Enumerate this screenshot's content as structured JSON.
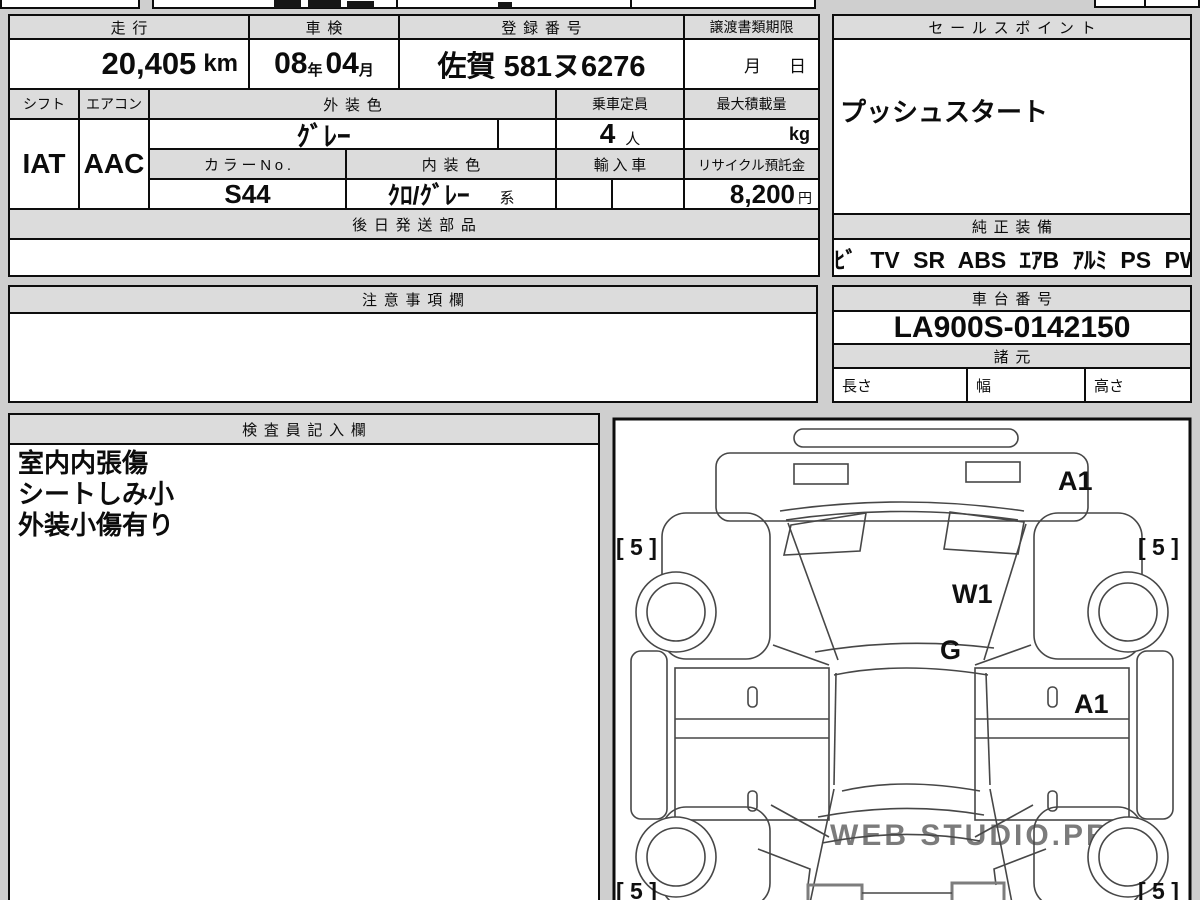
{
  "colors": {
    "page_bg": "#cfcfcf",
    "header_fill": "#dcdcdc",
    "cell_bg": "#ffffff",
    "border": "#0d0d0d",
    "diagram_line": "#474747",
    "watermark": "#c3c3c3"
  },
  "main_table": {
    "mileage_header": "走行",
    "inspection_header": "車検",
    "registration_header": "登録番号",
    "transfer_docs_header": "譲渡書類期限",
    "mileage_value": "20,405",
    "mileage_unit": "km",
    "inspection_year": "08",
    "inspection_year_unit": "年",
    "inspection_month": "04",
    "inspection_month_unit": "月",
    "registration_value": "佐賀 581ヌ6276",
    "transfer_month_label": "月",
    "transfer_day_label": "日",
    "shift_header": "シフト",
    "aircon_header": "エアコン",
    "exterior_color_header": "外装色",
    "capacity_header": "乗車定員",
    "max_load_header": "最大積載量",
    "exterior_color_value": "ｸﾞﾚｰ",
    "capacity_value": "4",
    "capacity_unit": "人",
    "max_load_unit": "kg",
    "shift_value": "IAT",
    "aircon_value": "AAC",
    "color_no_header": "カラーNo.",
    "interior_color_header": "内装色",
    "import_header": "輸入車",
    "recycle_header": "リサイクル預託金",
    "color_no_value": "S44",
    "interior_color_value": "ｸﾛ/ｸﾞﾚｰ",
    "interior_color_suffix": "系",
    "recycle_value": "8,200",
    "recycle_unit": "円",
    "later_parts_header": "後日発送部品"
  },
  "sales_panel": {
    "header": "セールスポイント",
    "point": "プッシュスタート",
    "genuine_equipment_header": "純正装備",
    "equipment": "ﾅﾋﾞ TV SR ABS ｴｱB ｱﾙﾐ PS PW"
  },
  "notes_panel": {
    "header": "注意事項欄"
  },
  "chassis_panel": {
    "header": "車台番号",
    "chassis_number": "LA900S-0142150",
    "spec_header": "諸元",
    "length_label": "長さ",
    "width_label": "幅",
    "height_label": "高さ"
  },
  "inspector_panel": {
    "header": "検査員記入欄",
    "lines": [
      "室内内張傷",
      "シートしみ小",
      "外装小傷有り"
    ]
  },
  "diagram": {
    "rear_mark": "A1",
    "glass_mark": "W1",
    "roof_mark": "G",
    "door_mark": "A1",
    "tire_tl": "[ 5 ]",
    "tire_tr": "[ 5 ]",
    "tire_bl": "[ 5 ]",
    "tire_br": "[ 5 ]",
    "watermark": "WEB STUDIO.PRO"
  }
}
